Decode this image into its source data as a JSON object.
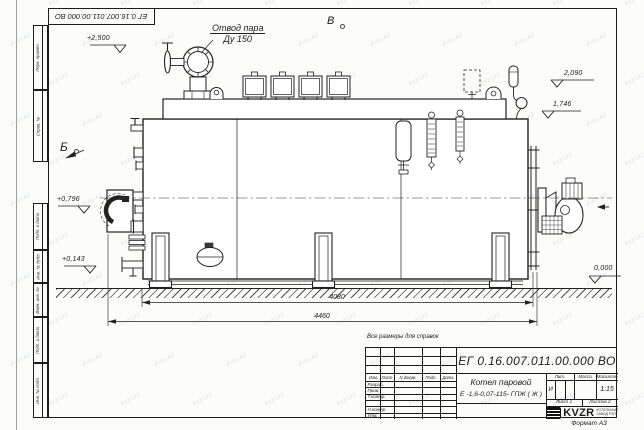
{
  "watermark": {
    "text": "kvzr.kz"
  },
  "frame": {
    "doc_number_top": "ЕГ 0.16.007.011.00.000  ВО",
    "side_labels": {
      "perv": "Перв. примен.",
      "sprav": "Справ. №",
      "podp1": "Подп. и дата",
      "inv_dubl": "Инв. № дубл.",
      "vzam": "Взам. инв. №",
      "podp2": "Подп. и дата",
      "inv_podl": "Инв. № подл."
    },
    "format_note": "Формат А3"
  },
  "annotations": {
    "reference_note": "Все размеры для справок",
    "steam_line1": "Отвод пара",
    "steam_line2": "Ду 150",
    "view_top": "В",
    "view_left": "Б",
    "levels": {
      "l_2500": "+2,500",
      "l_2090": "2,090",
      "l_1746": "1,746",
      "l_0796": "+0,796",
      "l_0143": "+0,143",
      "l_0000": "0,000"
    },
    "dims": {
      "inner": "4080",
      "outer": "4460"
    }
  },
  "title_block": {
    "doc_number": "ЕГ 0.16.007.011.00.000  ВО",
    "product_name": "Котел паровой",
    "product_type": "Е -1,6-0,07-115- ГПЖ ( Ж )",
    "columns": {
      "izm": "Изм",
      "list": "Лист",
      "dokum": "N докум.",
      "podp": "Подп.",
      "data": "Дата"
    },
    "rows": {
      "razrab": "Разраб.",
      "prov": "Пров.",
      "tkontr": "Т.контр.",
      "nkontr": "Н.контр.",
      "utv": "Утв."
    },
    "lit_header": "Лит.",
    "mass_header": "Масса",
    "scale_header": "Масштаб",
    "lit_value": "И",
    "scale_value": "1:15",
    "sheet": "Лист 1",
    "sheets": "Листов 2",
    "logo": {
      "name": "KVZR",
      "sub1": "КОТЕЛЬНЫЙ",
      "sub2": "ЗАВОД РЭП"
    }
  }
}
